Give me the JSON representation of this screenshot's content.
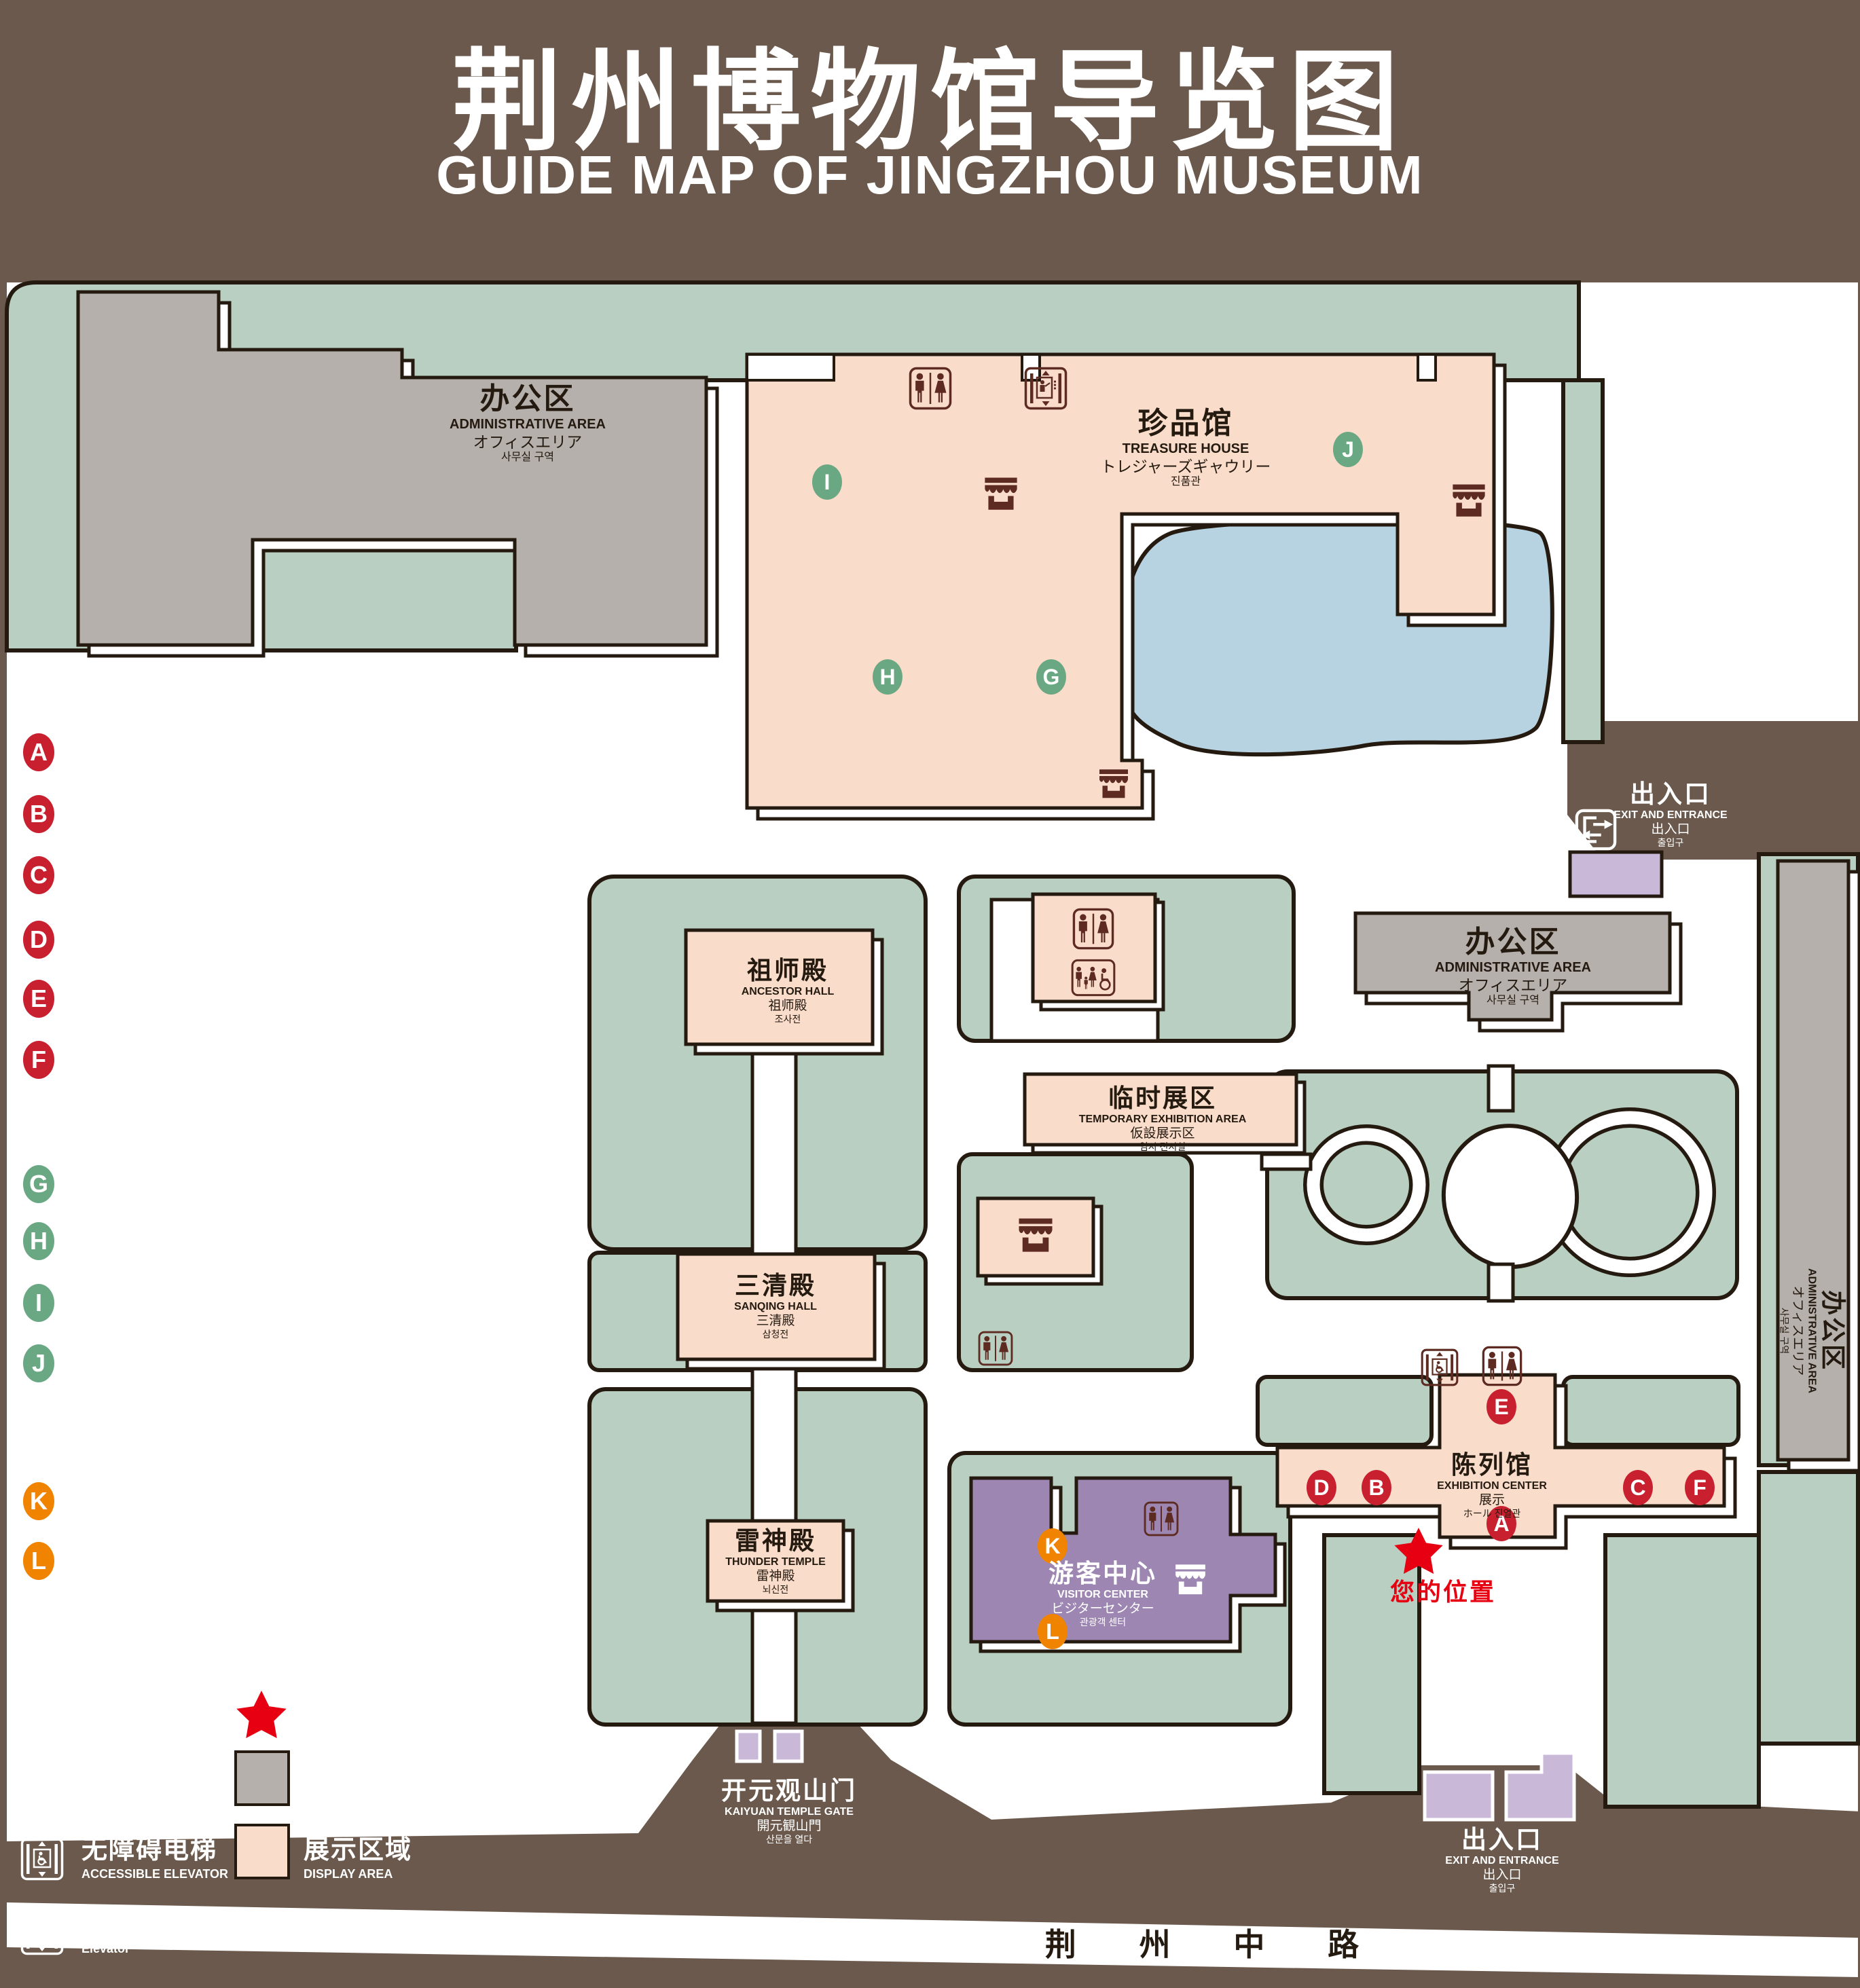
{
  "title": {
    "zh": "荆州博物馆导览图",
    "en": "GUIDE MAP OF JINGZHOU MUSEUM"
  },
  "colors": {
    "background": "#6a594c",
    "lawn_green": "#b9cfc1",
    "display_pink": "#fadcca",
    "office_gray": "#b5b0ac",
    "visitor_purple": "#9d87b2",
    "gate_purple": "#c9b8d8",
    "water_blue": "#b7d2e1",
    "outline": "#241a10",
    "badge_red": "#c8202f",
    "badge_green": "#6aa883",
    "badge_orange": "#f08300",
    "icon_brown": "#5d2b21",
    "location_red": "#e60012"
  },
  "legend": {
    "sections": [
      {
        "zh": "陈列馆",
        "en": "EXHIBITION CENTER",
        "items": [
          {
            "key": "A",
            "zh": "《火中的凤凰》壁画",
            "en": "THE PHOENIX IN FIRE \"MURAL PAINTING",
            "floor": "1F"
          },
          {
            "key": "B",
            "zh": "荆州出土铜器展",
            "en": "JINGZHOU UNEARTHED BRONZE WARE EXHIBITION",
            "floor": "1F"
          },
          {
            "key": "C",
            "zh": "江汉平原原始文化展",
            "en": "JIANGHAN PLAIN PRIMITIVE CULTURE EXHIBITION",
            "floor": "1F"
          },
          {
            "key": "D",
            "zh": "荆州出土瓷器展",
            "en": "JINGZHOU UNEARTHED PORCELAIN EXHIBITIONE",
            "floor": "2F"
          },
          {
            "key": "E",
            "zh": "荆州出土简牍展",
            "en": "JINGZHOU EXCAVATED BAMBOO SLIPS EXHIBITION",
            "floor": "2F"
          },
          {
            "key": "F",
            "zh": "荆州出土玉器展",
            "en": "JINGZHOU UNEARTHED JADE EXHIBITION",
            "floor": "2F"
          }
        ]
      },
      {
        "zh": "珍品馆",
        "en": "TREASURE HOUSE",
        "items": [
          {
            "key": "G",
            "zh": "放映厅",
            "en": "PROJECTION HALL",
            "floor": "1F"
          },
          {
            "key": "H",
            "zh": "互动体验厅",
            "en": "INTERACTIVE EXPERIENCE HALL",
            "floor": "1F"
          },
          {
            "key": "I",
            "zh": "五大夫遂——凤凰山168号汉墓展",
            "en": "WUDAFU—EXHIBITION OF NO.168 HAN TOMB FROM FENGHUANGSHAN",
            "floor": "2F"
          },
          {
            "key": "J",
            "zh": "丹漆神韵——楚秦汉漆器精品展",
            "en": "ROMANTIC CHARM OF THE CRIMSON LACQUERS—EXHIBITIONS OF FINE LACQUERS FROM CHU,QIN AND HAN DYNASTIES",
            "floor": "1-2F"
          }
        ]
      },
      {
        "zh": "游客中心",
        "en": "VISITOR CENTER",
        "items": [
          {
            "key": "K",
            "zh": "安全保卫",
            "en": "SECURITY",
            "floor": "1F"
          },
          {
            "key": "L",
            "zh": "医疗点",
            "en": "CLINIC",
            "floor": "1F"
          }
        ]
      }
    ],
    "symbols_left": [
      {
        "icon": "store-icon",
        "zh": "文创商店",
        "en": "STORE"
      },
      {
        "icon": "restrooms-icon",
        "zh": "卫生间",
        "en": "RESTROOMS"
      },
      {
        "icon": "family-restrooms-icon",
        "zh": "家庭卫生间",
        "en": "FAMILY RESTROOMS"
      },
      {
        "icon": "accessible-elevator-icon",
        "zh": "无障碍电梯",
        "en": "ACCESSIBLE ELEVATOR"
      },
      {
        "icon": "elevator-icon",
        "zh": "电梯",
        "en": "Elevator"
      }
    ],
    "symbols_right": [
      {
        "icon": "exit-entrance-icon",
        "zh": "出入口",
        "en": "EXIT AND ENTRANCE"
      },
      {
        "icon": "your-location-icon",
        "zh": "您的位置",
        "en": "YOUR LOCATION"
      },
      {
        "icon": "office-area-swatch",
        "zh": "办公区域",
        "en": "OFFICE AREA"
      },
      {
        "icon": "display-area-swatch",
        "zh": "展示区域",
        "en": "DISPLAY AREA"
      }
    ]
  },
  "map": {
    "buildings": {
      "admin": {
        "l1": "办公区",
        "l2": "ADMINISTRATIVE AREA",
        "l3": "オフィスエリア",
        "l4": "사무실 구역"
      },
      "treasure_house": {
        "l1": "珍品馆",
        "l2": "TREASURE HOUSE",
        "l3": "トレジャーズギャウリー",
        "l4": "진품관"
      },
      "ancestor_hall": {
        "l1": "祖师殿",
        "l2": "ANCESTOR HALL",
        "l3": "祖师殿",
        "l4": "조사전"
      },
      "temporary_exhibition": {
        "l1": "临时展区",
        "l2": "TEMPORARY EXHIBITION AREA",
        "l3": "仮設展示区",
        "l4": "임시 전시실"
      },
      "sanqing_hall": {
        "l1": "三清殿",
        "l2": "SANQING HALL",
        "l3": "三清殿",
        "l4": "삼청전"
      },
      "thunder_temple": {
        "l1": "雷神殿",
        "l2": "THUNDER TEMPLE",
        "l3": "雷神殿",
        "l4": "뇌신전"
      },
      "visitor_center": {
        "l1": "游客中心",
        "l2": "VISITOR CENTER",
        "l3": "ビジターセンター",
        "l4": "관광객 센터"
      },
      "exhibition_center": {
        "l1": "陈列馆",
        "l2": "EXHIBITION CENTER",
        "l3": "展示",
        "l4": "ホール 진열관"
      },
      "kaiyuan_gate": {
        "l1": "开元观山门",
        "l2": "KAIYUAN TEMPLE GATE",
        "l3": "開元観山門",
        "l4": "산문을 열다"
      },
      "exit_entrance": {
        "l1": "出入口",
        "l2": "EXIT AND ENTRANCE",
        "l3": "出入口",
        "l4": "출입구"
      }
    },
    "road": "荆 州 中 路",
    "your_location": "您的位置",
    "badges": [
      {
        "letter": "A"
      },
      {
        "letter": "B"
      },
      {
        "letter": "C"
      },
      {
        "letter": "D"
      },
      {
        "letter": "E"
      },
      {
        "letter": "F"
      },
      {
        "letter": "G"
      },
      {
        "letter": "H"
      },
      {
        "letter": "I"
      },
      {
        "letter": "J"
      },
      {
        "letter": "K"
      },
      {
        "letter": "L"
      }
    ]
  }
}
